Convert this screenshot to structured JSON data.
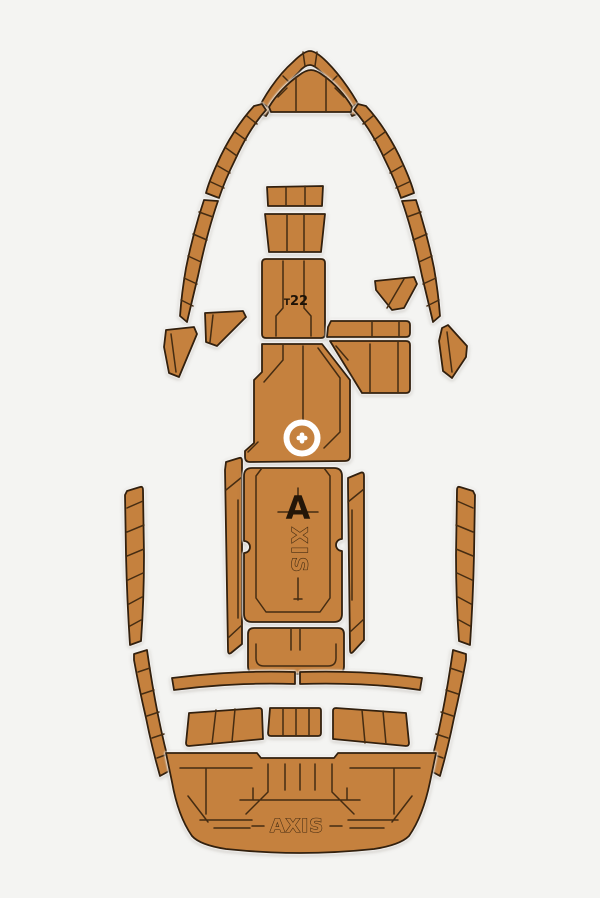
{
  "product": {
    "boat_model_label": {
      "prefix": "T",
      "number": "22"
    },
    "center_logo": {
      "letter_a": "A",
      "letters_xis": "XIS"
    },
    "stern_logo": "AXIS"
  },
  "colors": {
    "background": "#f4f4f2",
    "pad": "#c5813e",
    "pad_border": "#32200e",
    "seam": "#452c12",
    "halo": "#ffffff",
    "text": "#1d1206"
  }
}
